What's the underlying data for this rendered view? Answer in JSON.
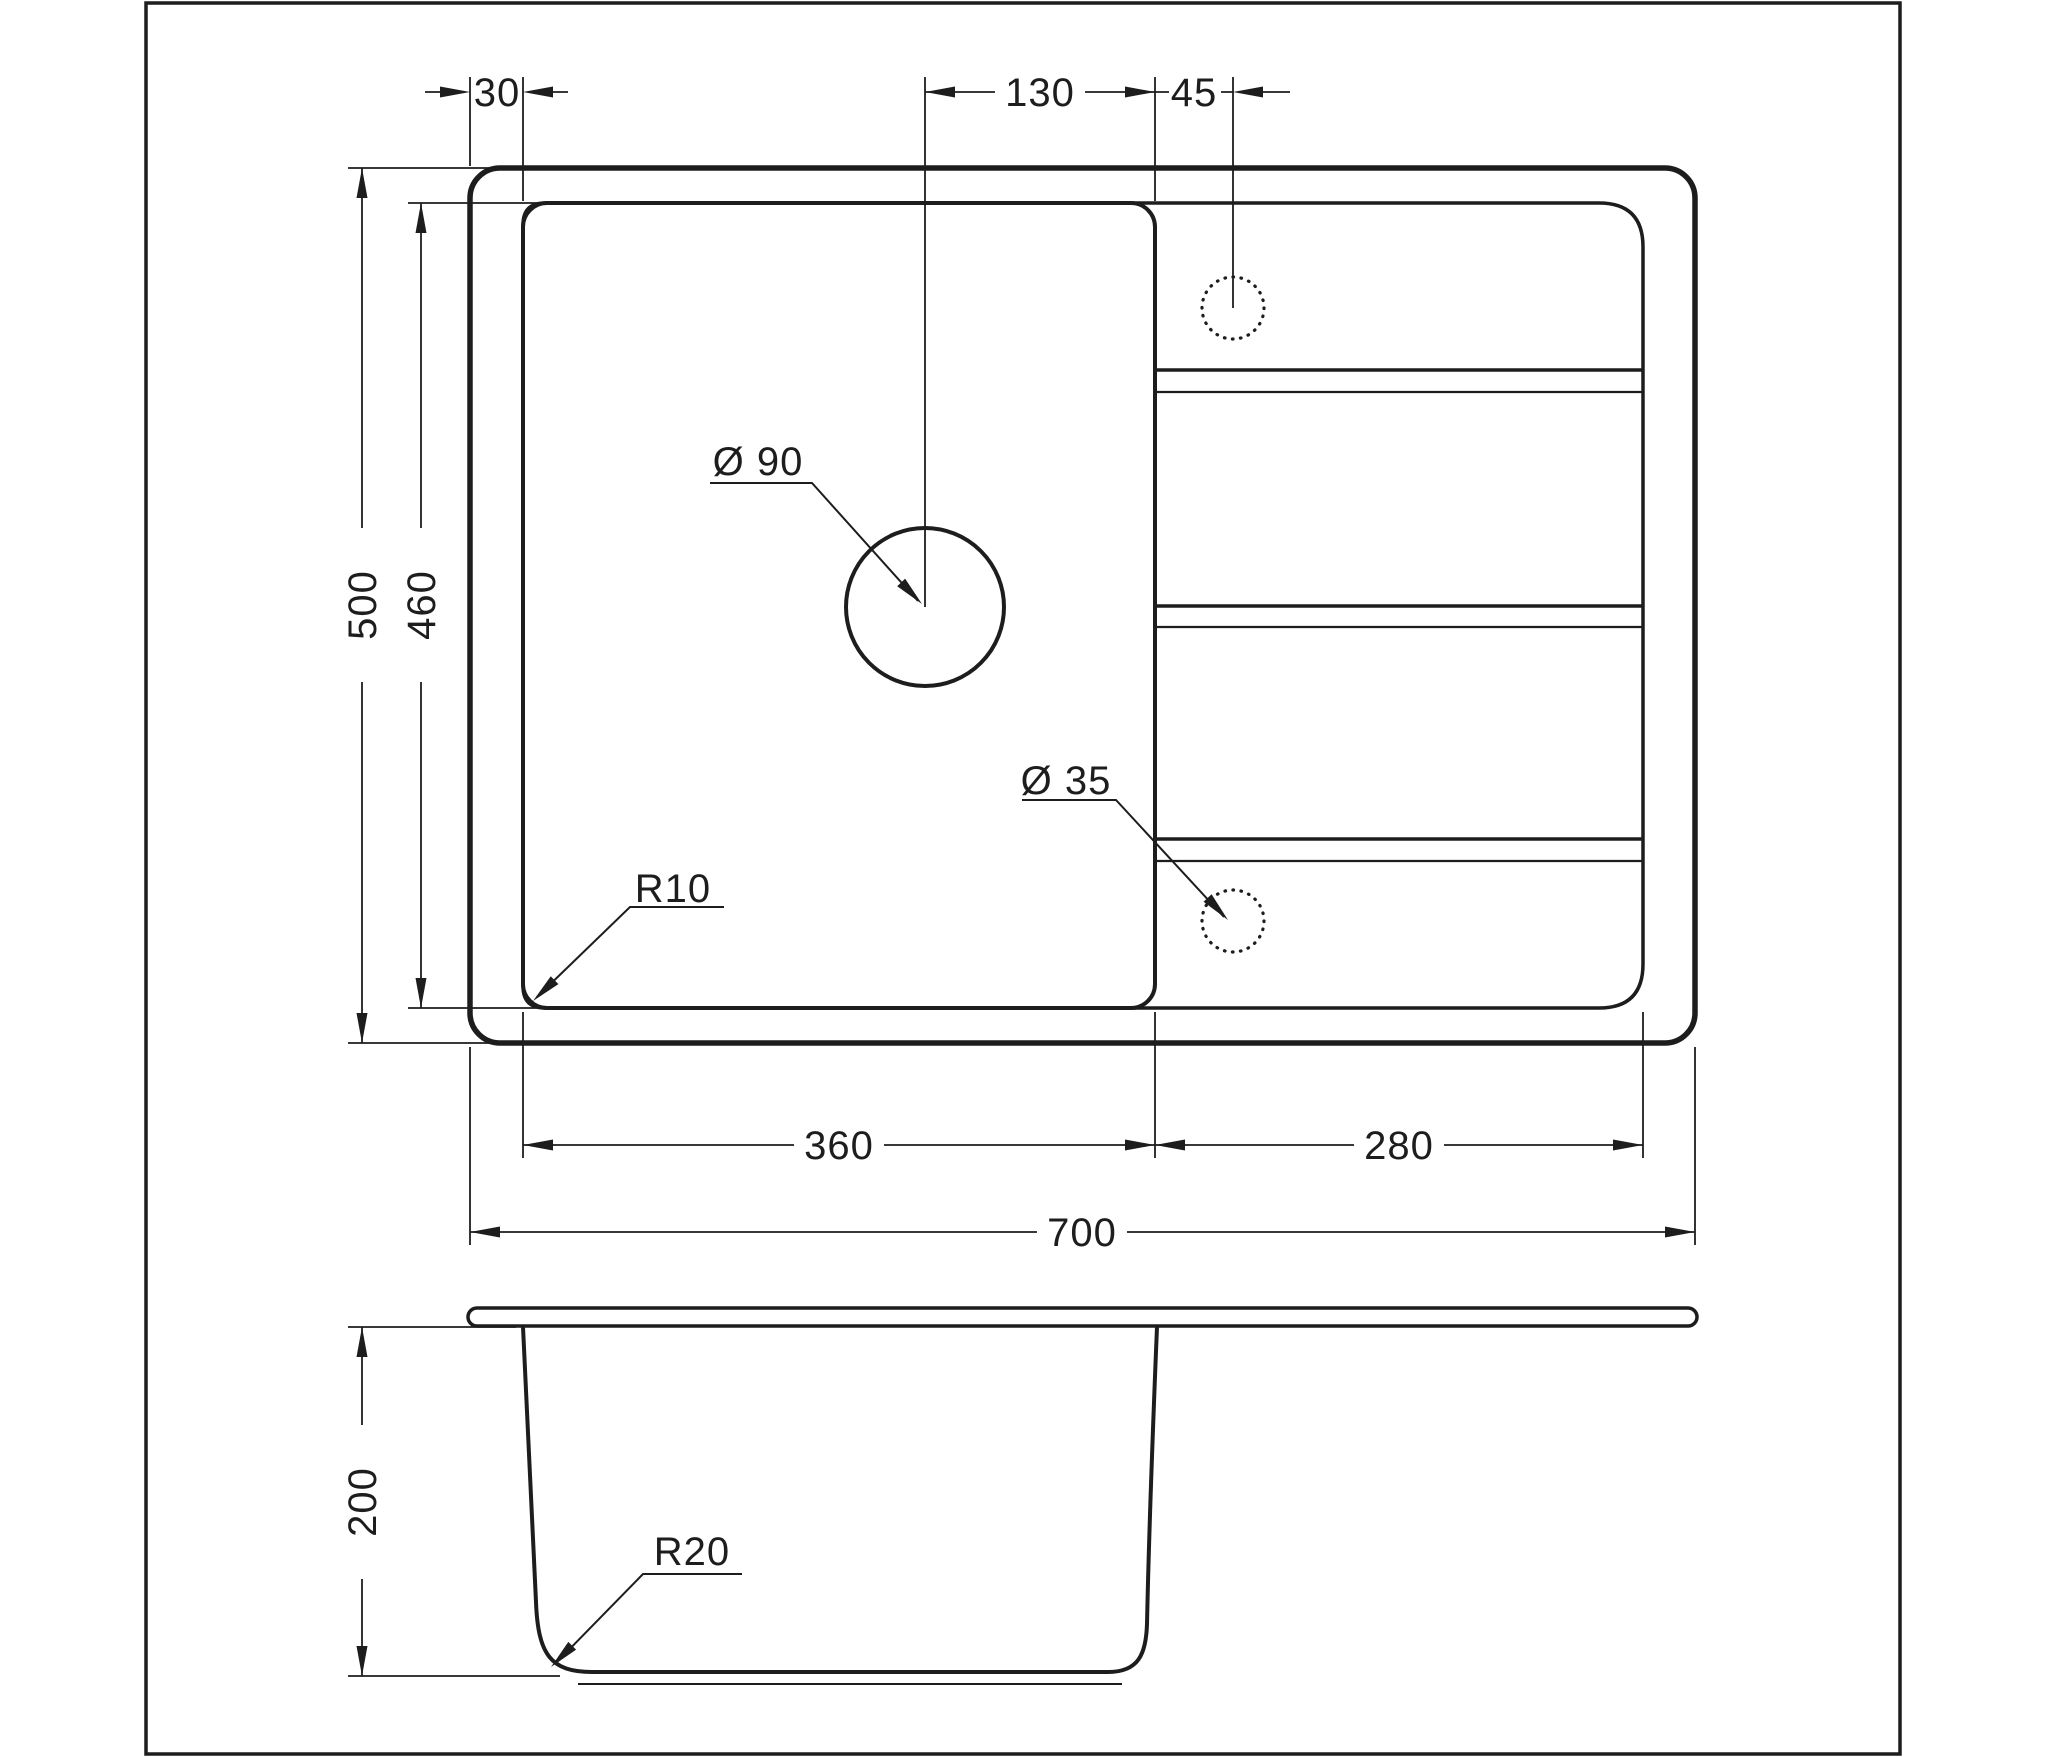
{
  "colors": {
    "line": "#1d1d1d",
    "background": "#ffffff"
  },
  "top_view": {
    "dimensions": {
      "rim_offset": "30",
      "drain_to_bowl_edge": "130",
      "tap_hole_offset": "45",
      "overall_depth": "500",
      "bowl_front_to_back": "460",
      "bowl_width": "360",
      "drainboard_width": "280",
      "overall_width": "700"
    },
    "callouts": {
      "drain_hole_diameter": "Ø 90",
      "tap_hole_diameter": "Ø 35",
      "bowl_corner_radius": "R10"
    }
  },
  "side_view": {
    "dimensions": {
      "bowl_depth": "200"
    },
    "callouts": {
      "bottom_corner_radius": "R20"
    }
  }
}
